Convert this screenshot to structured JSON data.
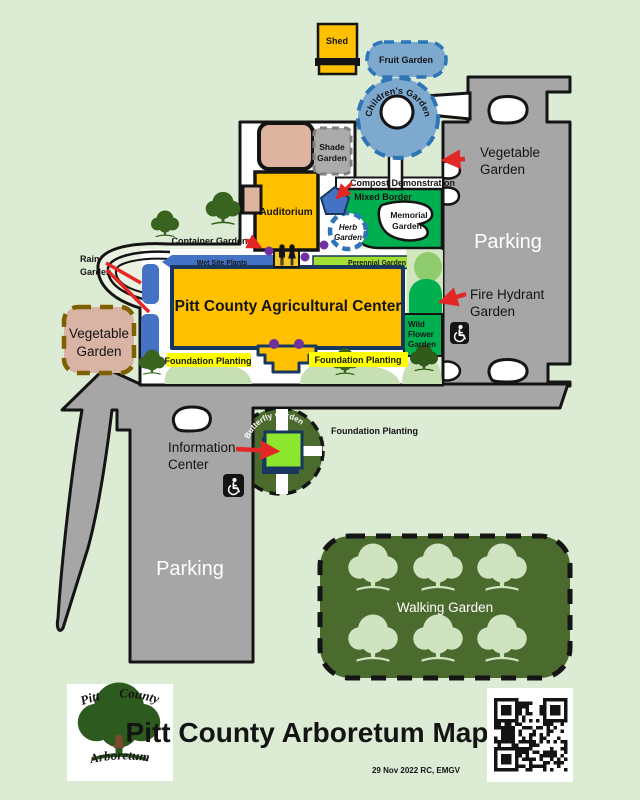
{
  "title": "Pitt County Arboretum Map",
  "date_note": "29 Nov 2022 RC, EMGV",
  "logo": {
    "top": "Pitt County",
    "bottom": "Arboretum"
  },
  "labels": {
    "shed": "Shed",
    "fruit_garden": "Fruit Garden",
    "childrens_garden": "Children's Garden",
    "shade_garden": [
      "Shade",
      "Garden"
    ],
    "vegetable_garden_right": [
      "Vegetable",
      "Garden"
    ],
    "compost_demonstration": "Compost Demonstration",
    "mixed_border": "Mixed Border",
    "memorial_garden": [
      "Memorial",
      "Garden"
    ],
    "herb_garden": [
      "Herb",
      "Garden"
    ],
    "auditorium": "Auditorium",
    "container_gardens": "Container Gardens",
    "rain_garden": [
      "Rain",
      "Garden"
    ],
    "wet_site_plants": "Wet Site Plants",
    "perennial_garden": "Perennial Garden",
    "ag_center": "Pitt County Agricultural Center",
    "fire_hydrant_garden": [
      "Fire Hydrant",
      "Garden"
    ],
    "wild_flower_garden": [
      "Wild",
      "Flower",
      "Garden"
    ],
    "vegetable_garden_left": [
      "Vegetable",
      "Garden"
    ],
    "parking_right": "Parking",
    "parking_left": "Parking",
    "foundation_planting_left": "Foundation Planting",
    "foundation_planting_right": "Foundation Planting",
    "foundation_planting_butterfly": "Foundation Planting",
    "butterfly_garden": "Butterfly Garden",
    "information_center": [
      "Information",
      "Center"
    ],
    "walking_garden": "Walking Garden"
  },
  "colors": {
    "bg": "#dcecd4",
    "campus": "#e9f2e1",
    "gray": "#a6a6a6",
    "outline": "#141414",
    "orange": "#ffc000",
    "navy": "#17375e",
    "tan": "#dcb49f",
    "shade_gray": "#ababab",
    "shade_border": "#7f7f7f",
    "blue_fill": "#7ea9cf",
    "blue_border": "#2e75b6",
    "royal_blue": "#4472c4",
    "green": "#00b050",
    "yellow_green": "#a2e036",
    "info_green": "#8ce62e",
    "pale_green": "#c6e0b4",
    "dark_olive": "#4a6a2e",
    "pale_tree": "#cfe3c0",
    "tree_green": "#39641f",
    "purple": "#7030a0",
    "red": "#e32726",
    "yellow": "#ffff00",
    "veg_tan": "#d9b3a3",
    "veg_border": "#7f6000"
  }
}
